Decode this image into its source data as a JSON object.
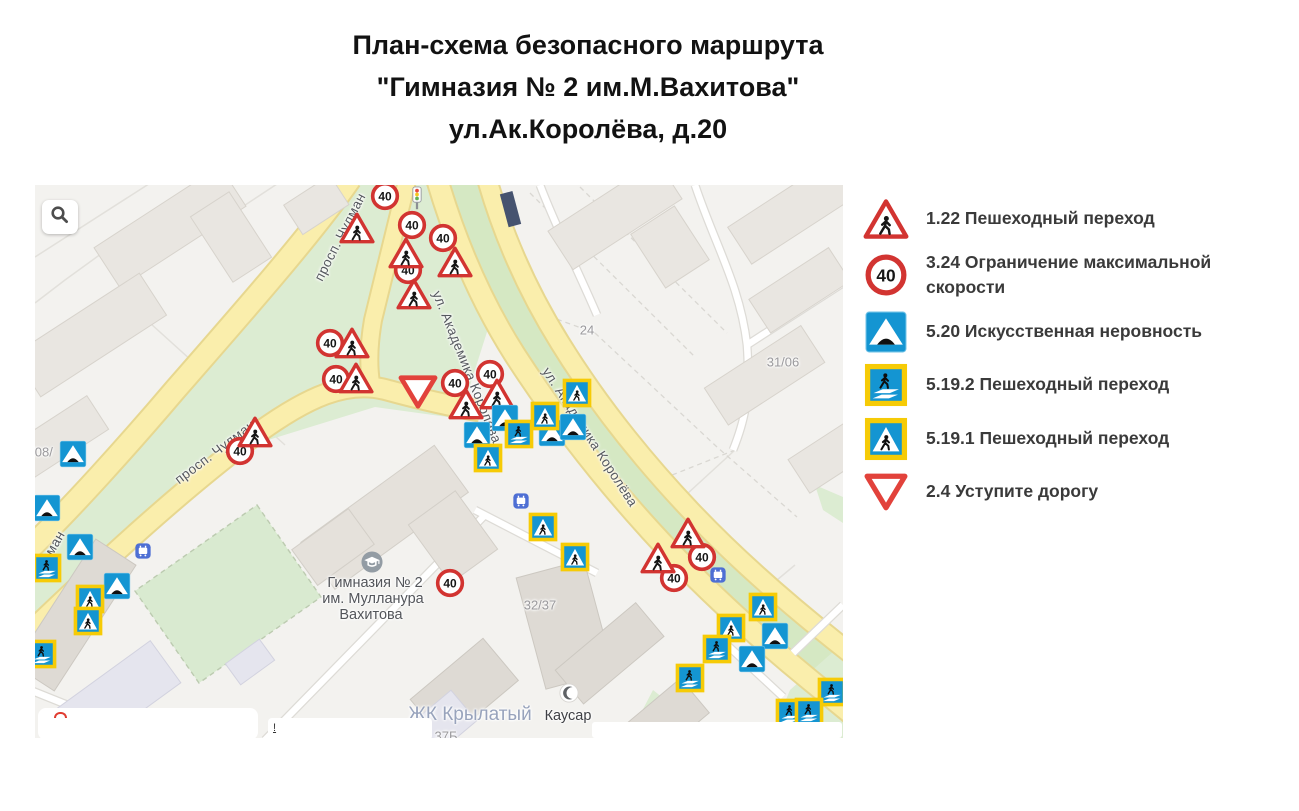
{
  "title": {
    "line1": "План-схема безопасного маршрута",
    "line2": "\"Гимназия № 2 им.М.Вахитова\"",
    "line3": "ул.Ак.Королёва, д.20"
  },
  "legend": {
    "items": [
      {
        "type": "ptri",
        "icon": "sign-1.22-icon",
        "label": "1.22 Пешеходный переход"
      },
      {
        "type": "s40",
        "icon": "sign-3.24-icon",
        "label": "3.24 Ограничение максимальной скорости"
      },
      {
        "type": "bump",
        "icon": "sign-5.20-icon",
        "label": "5.20 Искусственная неровность"
      },
      {
        "type": "pb2",
        "icon": "sign-5.19.2-icon",
        "label": "5.19.2 Пешеходный переход"
      },
      {
        "type": "pb1",
        "icon": "sign-5.19.1-icon",
        "label": "5.19.1 Пешеходный переход"
      },
      {
        "type": "gw",
        "icon": "sign-2.4-icon",
        "label": "2.4 Уступите дорогу"
      }
    ]
  },
  "map": {
    "signs": [
      {
        "type": "s40",
        "name": "sign-3.24-speed-40",
        "points": [
          [
            350,
            11
          ],
          [
            377,
            40
          ],
          [
            408,
            53
          ],
          [
            373,
            85
          ],
          [
            295,
            158
          ],
          [
            301,
            194
          ],
          [
            420,
            198
          ],
          [
            455,
            189
          ],
          [
            205,
            266
          ],
          [
            415,
            398
          ],
          [
            667,
            372
          ],
          [
            639,
            393
          ]
        ]
      },
      {
        "type": "ptri",
        "name": "sign-1.22-ped-crossing-warning",
        "points": [
          [
            322,
            43
          ],
          [
            371,
            68
          ],
          [
            420,
            77
          ],
          [
            379,
            109
          ],
          [
            317,
            158
          ],
          [
            321,
            193
          ],
          [
            431,
            219
          ],
          [
            462,
            209
          ],
          [
            220,
            247
          ],
          [
            653,
            348
          ],
          [
            623,
            373
          ]
        ]
      },
      {
        "type": "gw",
        "name": "sign-2.4-give-way",
        "points": [
          [
            383,
            207
          ]
        ]
      },
      {
        "type": "bump",
        "name": "sign-5.20-speed-bump",
        "points": [
          [
            38,
            269
          ],
          [
            12,
            323
          ],
          [
            45,
            362
          ],
          [
            82,
            401
          ],
          [
            442,
            250
          ],
          [
            470,
            233
          ],
          [
            517,
            248
          ],
          [
            538,
            242
          ],
          [
            740,
            451
          ],
          [
            717,
            474
          ]
        ]
      },
      {
        "type": "pb1",
        "name": "sign-5.19.1-ped-crossing",
        "points": [
          [
            55,
            414
          ],
          [
            53,
            436
          ],
          [
            453,
            273
          ],
          [
            510,
            231
          ],
          [
            542,
            208
          ],
          [
            508,
            342
          ],
          [
            540,
            372
          ],
          [
            728,
            422
          ],
          [
            696,
            443
          ]
        ]
      },
      {
        "type": "pb2",
        "name": "sign-5.19.2-ped-crossing",
        "points": [
          [
            12,
            383
          ],
          [
            7,
            469
          ],
          [
            484,
            249
          ],
          [
            682,
            464
          ],
          [
            655,
            493
          ],
          [
            797,
            507
          ],
          [
            755,
            528
          ],
          [
            774,
            527
          ]
        ]
      },
      {
        "type": "bus",
        "name": "bus-stop-icon",
        "points": [
          [
            108,
            366
          ],
          [
            486,
            316
          ],
          [
            683,
            390
          ]
        ]
      },
      {
        "type": "tl",
        "name": "traffic-light-icon",
        "points": [
          [
            382,
            14
          ]
        ]
      },
      {
        "type": "school",
        "name": "school-poi-icon",
        "points": [
          [
            337,
            377
          ]
        ]
      },
      {
        "type": "mosque",
        "name": "mosque-poi-icon",
        "points": [
          [
            534,
            508
          ]
        ]
      }
    ],
    "labels": [
      {
        "text": "просп. Чулман",
        "x": 305,
        "y": 52,
        "rot": -63,
        "cls": "street"
      },
      {
        "text": "просп. Чулман",
        "x": 180,
        "y": 267,
        "rot": -37,
        "cls": "street"
      },
      {
        "text": "ман",
        "x": 20,
        "y": 358,
        "rot": -60,
        "cls": "street"
      },
      {
        "text": "ул. Академика Королёва",
        "x": 432,
        "y": 182,
        "rot": 68,
        "cls": "street"
      },
      {
        "text": "ул. Академика Королёва",
        "x": 555,
        "y": 252,
        "rot": 57,
        "cls": "street"
      },
      {
        "text": "24",
        "x": 552,
        "y": 145,
        "rot": 0,
        "cls": "bnum"
      },
      {
        "text": "31/06",
        "x": 748,
        "y": 177,
        "rot": 0,
        "cls": "bnum"
      },
      {
        "text": "32/37",
        "x": 505,
        "y": 420,
        "rot": 0,
        "cls": "bnum"
      },
      {
        "text": "37Б",
        "x": 411,
        "y": 551,
        "rot": 0,
        "cls": "bnum"
      },
      {
        "text": "ЖК Крылатый",
        "x": 435,
        "y": 530,
        "rot": 0,
        "cls": "complex"
      },
      {
        "text": "Каусар",
        "x": 533,
        "y": 531,
        "rot": 0,
        "cls": "poi"
      },
      {
        "text": "/08/",
        "x": 7,
        "y": 267,
        "rot": 0,
        "cls": "bnum"
      },
      {
        "text": "Гимназия № 2",
        "x": 340,
        "y": 398,
        "rot": 0,
        "cls": "school"
      },
      {
        "text": "им. Мулланура",
        "x": 338,
        "y": 414,
        "rot": 0,
        "cls": "school"
      },
      {
        "text": "Вахитова",
        "x": 336,
        "y": 430,
        "rot": 0,
        "cls": "school"
      }
    ],
    "overlay_bars": [
      {
        "x": 3,
        "y": 523,
        "w": 220,
        "h": 32,
        "r": 8,
        "exclaim": ""
      },
      {
        "x": 233,
        "y": 533,
        "w": 164,
        "h": 22,
        "r": 4,
        "exclaim": "!"
      },
      {
        "x": 557,
        "y": 537,
        "w": 250,
        "h": 16,
        "r": 3,
        "exclaim": ""
      }
    ]
  },
  "colors": {
    "sign_red": "#d23431",
    "give_way_red": "#e2423b",
    "sign_blue": "#1495d2",
    "sign_yellow_border": "#f6cb06",
    "road_yellow": "#faeeac",
    "map_green": "#dcecd2",
    "map_bg": "#f3f2ef"
  }
}
